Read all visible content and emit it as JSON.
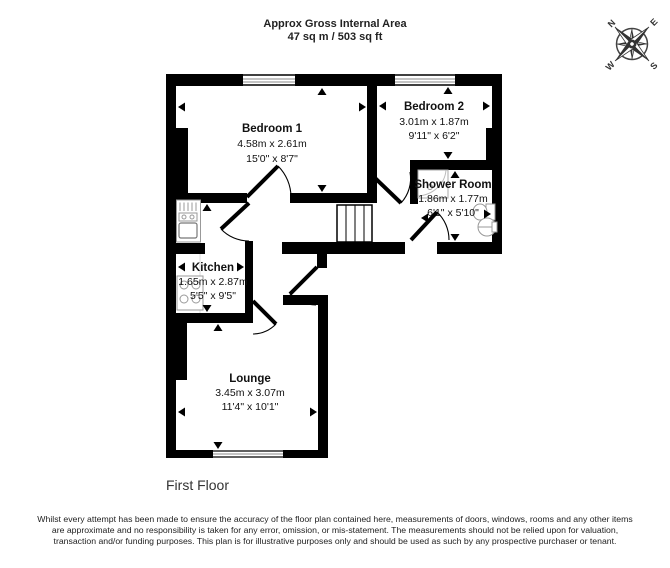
{
  "header": {
    "title_line1": "Approx Gross Internal Area",
    "title_line2": "47 sq m / 503 sq ft"
  },
  "floor_label": "First Floor",
  "rooms": [
    {
      "name": "Bedroom 1",
      "metric": "4.58m x 2.61m",
      "imperial": "15'0\" x 8'7\""
    },
    {
      "name": "Bedroom 2",
      "metric": "3.01m x 1.87m",
      "imperial": "9'11\" x 6'2\""
    },
    {
      "name": "Shower Room",
      "metric": "1.86m x 1.77m",
      "imperial": "6'1\" x 5'10\""
    },
    {
      "name": "Kitchen",
      "metric": "1.65m x 2.87m",
      "imperial": "5'5\" x 9'5\""
    },
    {
      "name": "Lounge",
      "metric": "3.45m x 3.07m",
      "imperial": "11'4\" x 10'1\""
    }
  ],
  "compass": {
    "n": "N",
    "e": "E",
    "s": "S",
    "w": "W"
  },
  "colors": {
    "wall": "#000000",
    "fixture": "#999999",
    "text": "#1a1a1a"
  },
  "disclaimer": "Whilst every attempt has been made to ensure the accuracy of the floor plan contained here, measurements of doors, windows, rooms and any other items are approximate and no responsibility is taken for any error, omission, or mis-statement. The measurements should not be relied upon for valuation, transaction and/or funding purposes. This plan is for illustrative purposes only and should be used as such by any prospective purchaser or tenant."
}
